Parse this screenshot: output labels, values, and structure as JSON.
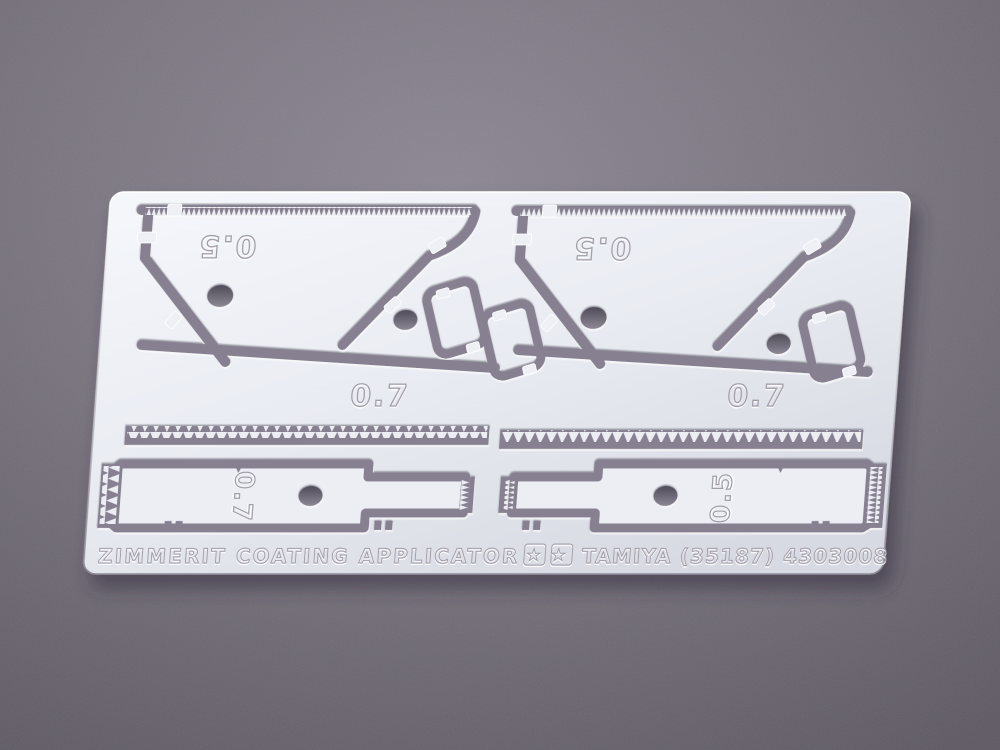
{
  "photo": {
    "etched_part_labels": {
      "top_left_blade": "0.5",
      "top_right_blade": "0.5",
      "lower_left_blade": "0.7",
      "lower_right_blade": "0.7",
      "left_tool": "0.7",
      "right_tool": "0.5"
    },
    "footer": {
      "product_name": "ZIMMERIT COATING APPLICATOR",
      "logo_stars": "★★",
      "brand_line": "TAMIYA (35187) 4303008"
    },
    "colors": {
      "background": "#77727b",
      "sheet_metal": "#eceef4",
      "etched_channel": "#868090",
      "channel_shadow": "#433f4c",
      "engraving_stroke": "#a29eaa",
      "engraving_highlight": "#ffffff"
    }
  }
}
